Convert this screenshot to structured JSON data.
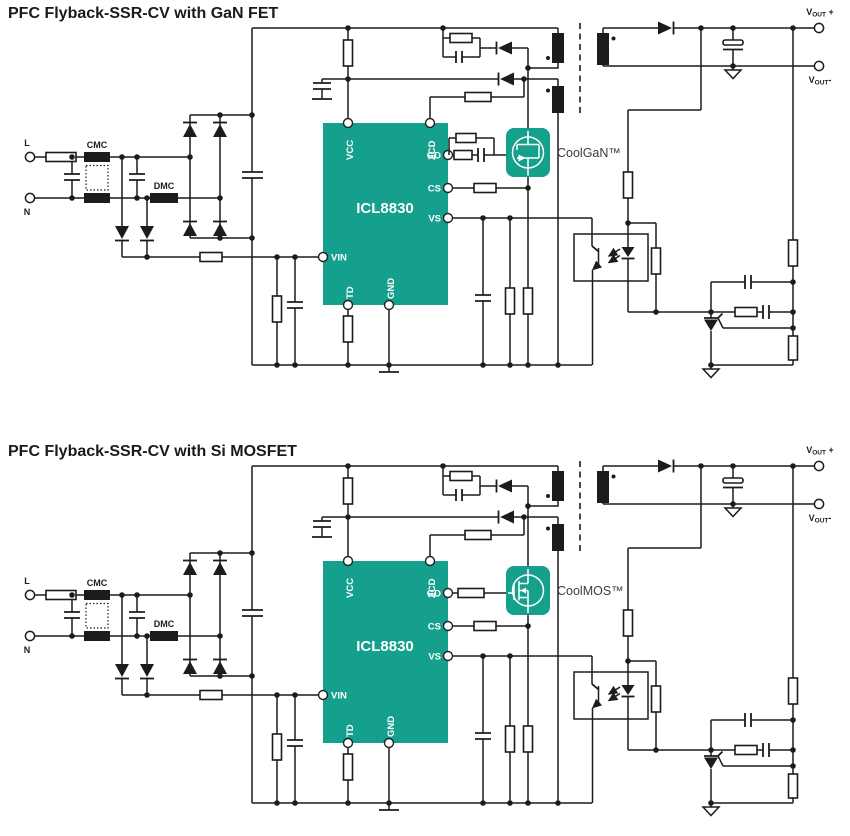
{
  "colors": {
    "teal": "#14A08C",
    "wire": "#1c1c1c",
    "label": "#3c3c3c"
  },
  "diagram1": {
    "title": "PFC Flyback-SSR-CV with GaN FET",
    "fet_label": "CoolGaN™"
  },
  "diagram2": {
    "title": "PFC Flyback-SSR-CV with Si MOSFET",
    "fet_label": "CoolMOS™"
  },
  "ic": {
    "part": "ICL8830",
    "pins": {
      "vcc": "VCC",
      "zcd": "ZCD",
      "gd": "GD",
      "cs": "CS",
      "vs": "VS",
      "vin": "VIN",
      "td": "TD",
      "gnd": "GND"
    }
  },
  "input": {
    "line": "L",
    "neutral": "N",
    "cmc": "CMC",
    "dmc": "DMC"
  },
  "output": {
    "vout_plus": {
      "v": "V",
      "sub": "OUT",
      "sign": " +"
    },
    "vout_minus": {
      "v": "V",
      "sub": "OUT",
      "sign": "-"
    }
  }
}
